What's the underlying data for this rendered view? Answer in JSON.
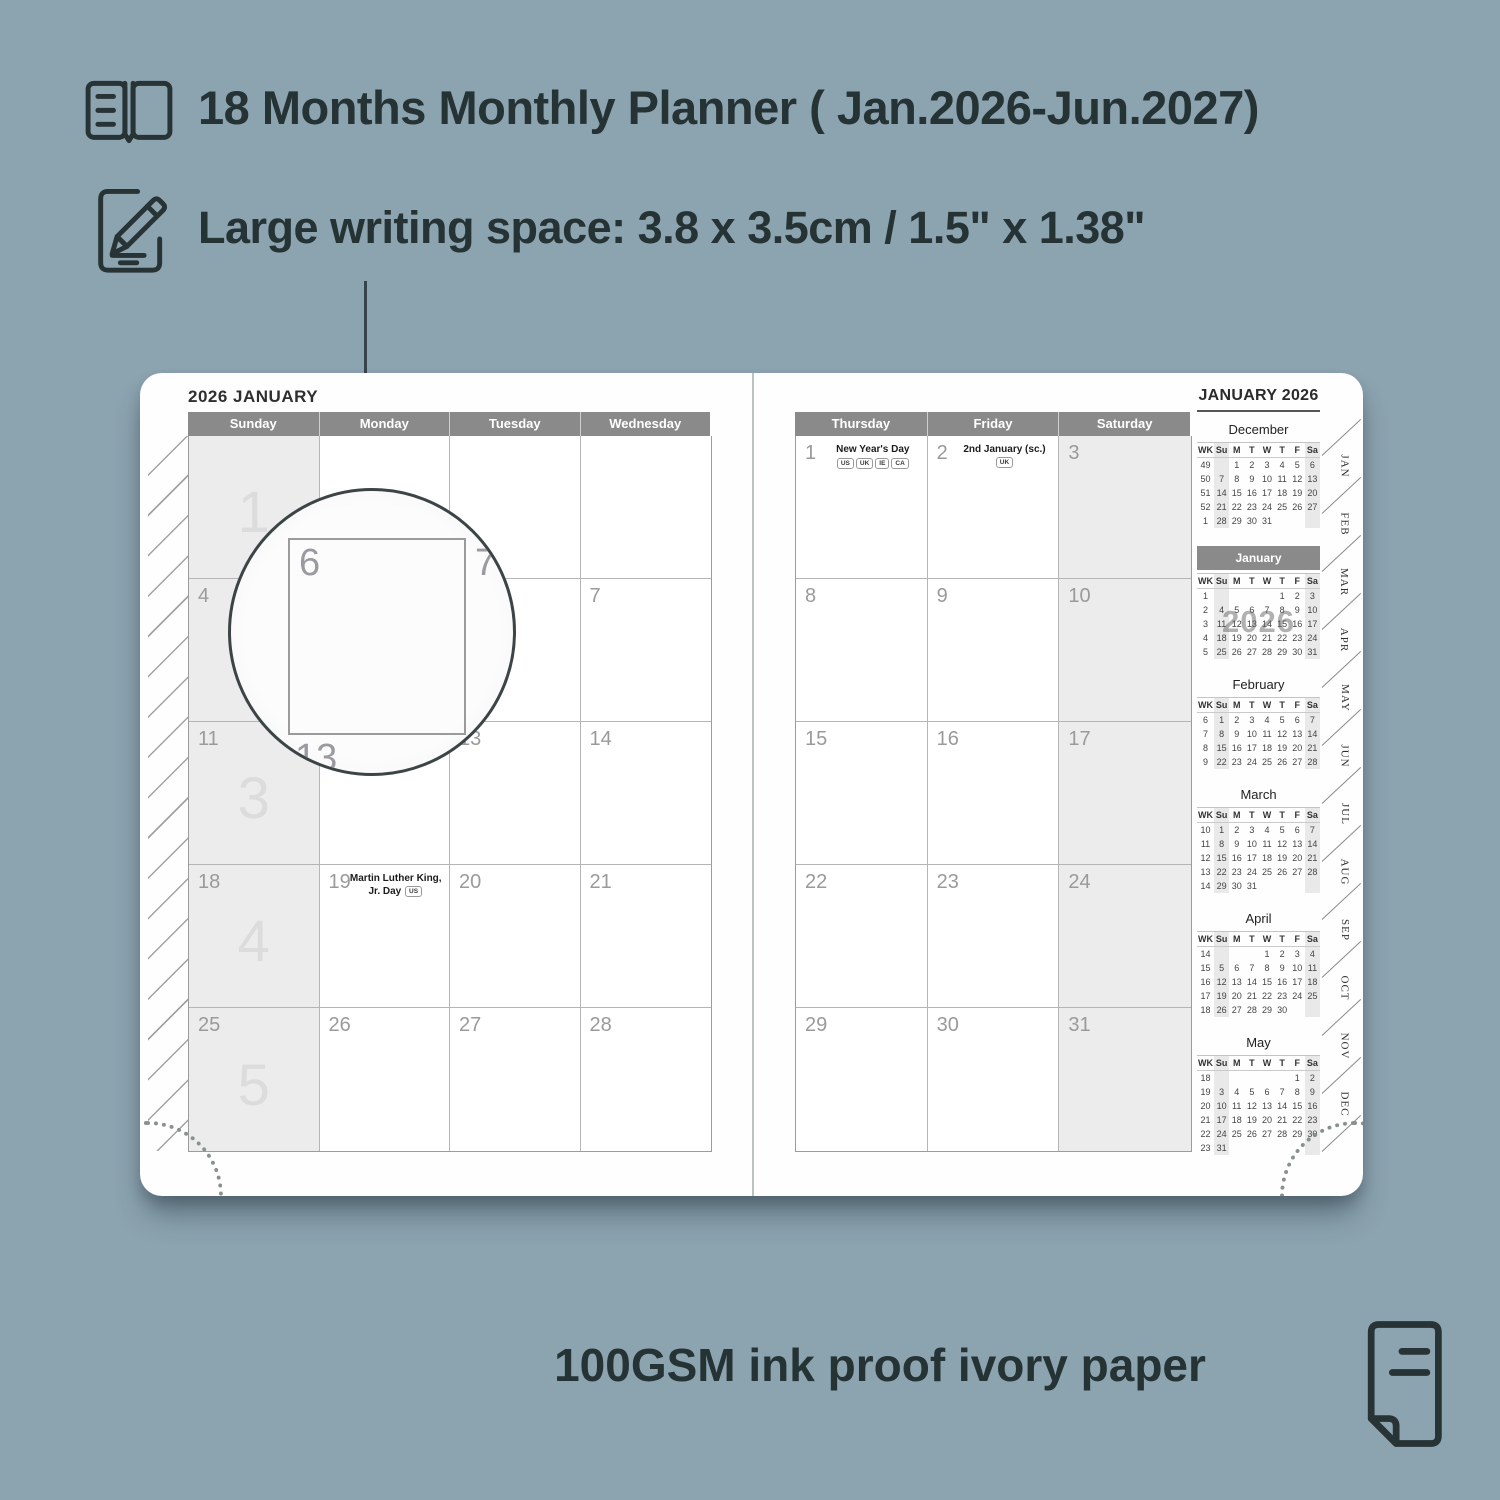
{
  "features": {
    "months_line": "18 Months Monthly Planner ( Jan.2026-Jun.2027)",
    "writing_space_line": "Large writing space: 3.8 x 3.5cm / 1.5\" x 1.38\"",
    "paper_line": "100GSM ink proof ivory paper"
  },
  "colors": {
    "background": "#8ca3b0",
    "page": "#fefefe",
    "header_band": "#8a8a8a",
    "cell_shade": "#ececec",
    "text_dark": "#263335"
  },
  "planner": {
    "left_page": {
      "title": "2026 JANUARY",
      "day_headers": [
        "Sunday",
        "Monday",
        "Tuesday",
        "Wednesday"
      ],
      "weeks": [
        {
          "watermark": "1",
          "days": [
            {
              "d": ""
            },
            {
              "d": ""
            },
            {
              "d": ""
            },
            {
              "d": ""
            }
          ]
        },
        {
          "watermark": "2",
          "days": [
            {
              "d": "4"
            },
            {
              "d": "5"
            },
            {
              "d": "6"
            },
            {
              "d": "7"
            }
          ]
        },
        {
          "watermark": "3",
          "days": [
            {
              "d": "11"
            },
            {
              "d": "12"
            },
            {
              "d": "13"
            },
            {
              "d": "14"
            }
          ]
        },
        {
          "watermark": "4",
          "days": [
            {
              "d": "18"
            },
            {
              "d": "19",
              "holiday": {
                "title": "Martin Luther King, Jr. Day",
                "badges": [
                  "US"
                ],
                "inline": true
              }
            },
            {
              "d": "20"
            },
            {
              "d": "21"
            }
          ]
        },
        {
          "watermark": "5",
          "days": [
            {
              "d": "25"
            },
            {
              "d": "26"
            },
            {
              "d": "27"
            },
            {
              "d": "28"
            }
          ]
        }
      ]
    },
    "right_page": {
      "day_headers": [
        "Thursday",
        "Friday",
        "Saturday"
      ],
      "weeks": [
        {
          "days": [
            {
              "d": "1",
              "holiday": {
                "title": "New Year's Day",
                "badges": [
                  "US",
                  "UK",
                  "IE",
                  "CA"
                ],
                "inline": false
              }
            },
            {
              "d": "2",
              "holiday": {
                "title": "2nd January (sc.)",
                "badges": [
                  "UK"
                ],
                "inline": true
              }
            },
            {
              "d": "3"
            }
          ]
        },
        {
          "days": [
            {
              "d": "8"
            },
            {
              "d": "9"
            },
            {
              "d": "10"
            }
          ]
        },
        {
          "days": [
            {
              "d": "15"
            },
            {
              "d": "16"
            },
            {
              "d": "17"
            }
          ]
        },
        {
          "days": [
            {
              "d": "22"
            },
            {
              "d": "23"
            },
            {
              "d": "24"
            }
          ]
        },
        {
          "days": [
            {
              "d": "29"
            },
            {
              "d": "30"
            },
            {
              "d": "31"
            }
          ]
        }
      ]
    },
    "sidebar": {
      "title": "JANUARY 2026",
      "weekday_header": [
        "WK",
        "Su",
        "M",
        "T",
        "W",
        "T",
        "F",
        "Sa"
      ],
      "mini_calendars": [
        {
          "name": "December",
          "wk": [
            "49",
            "50",
            "51",
            "52",
            "1"
          ],
          "rows": [
            [
              "",
              "1",
              "2",
              "3",
              "4",
              "5",
              "6"
            ],
            [
              "7",
              "8",
              "9",
              "10",
              "11",
              "12",
              "13"
            ],
            [
              "14",
              "15",
              "16",
              "17",
              "18",
              "19",
              "20"
            ],
            [
              "21",
              "22",
              "23",
              "24",
              "25",
              "26",
              "27"
            ],
            [
              "28",
              "29",
              "30",
              "31",
              "",
              "",
              ""
            ]
          ]
        },
        {
          "name": "January",
          "highlight": true,
          "watermark": "2026",
          "wk": [
            "1",
            "2",
            "3",
            "4",
            "5"
          ],
          "rows": [
            [
              "",
              "",
              "",
              "",
              "1",
              "2",
              "3"
            ],
            [
              "4",
              "5",
              "6",
              "7",
              "8",
              "9",
              "10"
            ],
            [
              "11",
              "12",
              "13",
              "14",
              "15",
              "16",
              "17"
            ],
            [
              "18",
              "19",
              "20",
              "21",
              "22",
              "23",
              "24"
            ],
            [
              "25",
              "26",
              "27",
              "28",
              "29",
              "30",
              "31"
            ]
          ]
        },
        {
          "name": "February",
          "wk": [
            "6",
            "7",
            "8",
            "9"
          ],
          "rows": [
            [
              "1",
              "2",
              "3",
              "4",
              "5",
              "6",
              "7"
            ],
            [
              "8",
              "9",
              "10",
              "11",
              "12",
              "13",
              "14"
            ],
            [
              "15",
              "16",
              "17",
              "18",
              "19",
              "20",
              "21"
            ],
            [
              "22",
              "23",
              "24",
              "25",
              "26",
              "27",
              "28"
            ]
          ]
        },
        {
          "name": "March",
          "wk": [
            "10",
            "11",
            "12",
            "13",
            "14"
          ],
          "rows": [
            [
              "1",
              "2",
              "3",
              "4",
              "5",
              "6",
              "7"
            ],
            [
              "8",
              "9",
              "10",
              "11",
              "12",
              "13",
              "14"
            ],
            [
              "15",
              "16",
              "17",
              "18",
              "19",
              "20",
              "21"
            ],
            [
              "22",
              "23",
              "24",
              "25",
              "26",
              "27",
              "28"
            ],
            [
              "29",
              "30",
              "31",
              "",
              "",
              "",
              ""
            ]
          ]
        },
        {
          "name": "April",
          "wk": [
            "14",
            "15",
            "16",
            "17",
            "18"
          ],
          "rows": [
            [
              "",
              "",
              "",
              "1",
              "2",
              "3",
              "4"
            ],
            [
              "5",
              "6",
              "7",
              "8",
              "9",
              "10",
              "11"
            ],
            [
              "12",
              "13",
              "14",
              "15",
              "16",
              "17",
              "18"
            ],
            [
              "19",
              "20",
              "21",
              "22",
              "23",
              "24",
              "25"
            ],
            [
              "26",
              "27",
              "28",
              "29",
              "30",
              "",
              ""
            ]
          ]
        },
        {
          "name": "May",
          "wk": [
            "18",
            "19",
            "20",
            "21",
            "22",
            "23"
          ],
          "rows": [
            [
              "",
              "",
              "",
              "",
              "",
              "1",
              "2"
            ],
            [
              "3",
              "4",
              "5",
              "6",
              "7",
              "8",
              "9"
            ],
            [
              "10",
              "11",
              "12",
              "13",
              "14",
              "15",
              "16"
            ],
            [
              "17",
              "18",
              "19",
              "20",
              "21",
              "22",
              "23"
            ],
            [
              "24",
              "25",
              "26",
              "27",
              "28",
              "29",
              "30"
            ],
            [
              "31",
              "",
              "",
              "",
              "",
              "",
              ""
            ]
          ]
        }
      ]
    },
    "tabs": [
      "JAN",
      "FEB",
      "MAR",
      "APR",
      "MAY",
      "JUN",
      "JUL",
      "AUG",
      "SEP",
      "OCT",
      "NOV",
      "DEC"
    ],
    "magnifier": {
      "cell_date": "6",
      "adjacent_date": "7",
      "below_date": "13"
    }
  }
}
